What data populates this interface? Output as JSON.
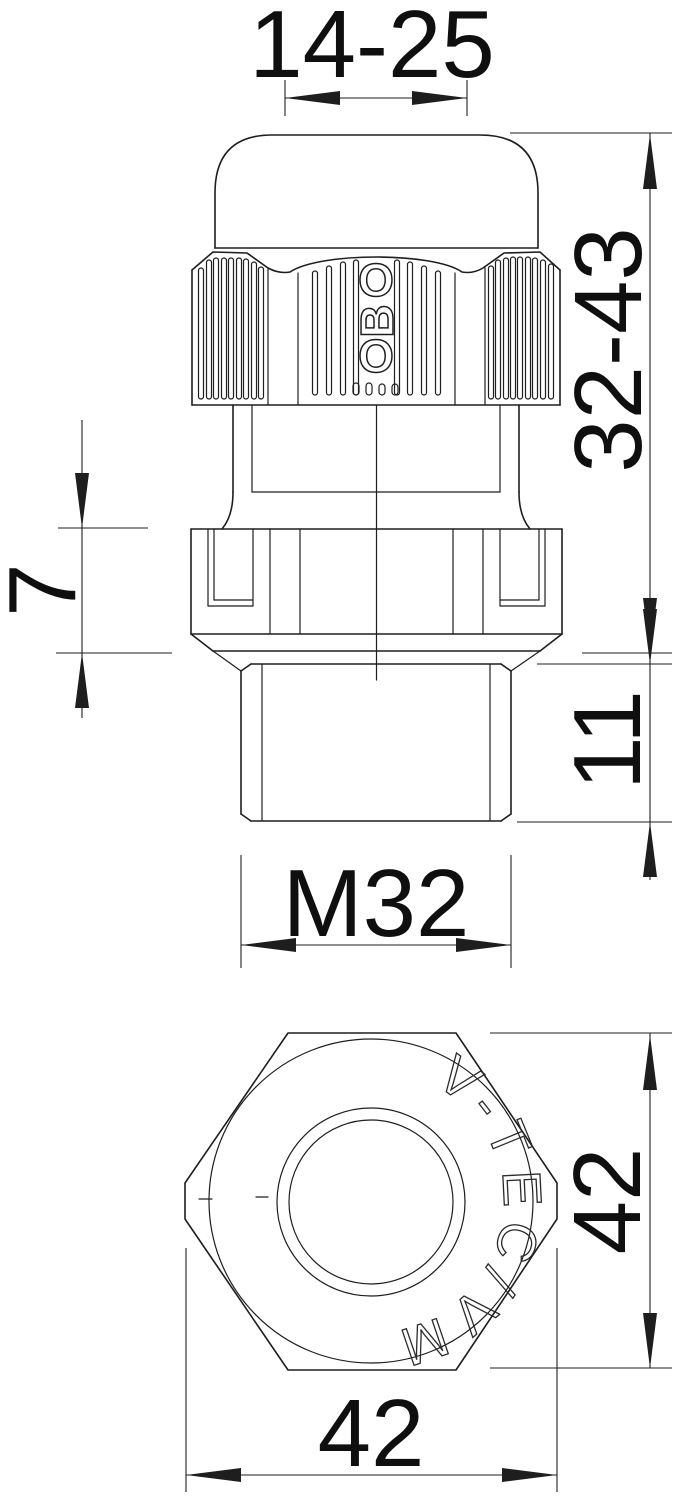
{
  "dimensions": {
    "clamping_range": "14-25",
    "overall_height_range": "32-43",
    "cap_travel": "7",
    "thread_length": "11",
    "thread_size": "M32",
    "wrench_size_side": "42",
    "wrench_size_bottom": "42"
  },
  "branding": {
    "logo_letters": [
      "O",
      "B",
      "O"
    ],
    "engraving": "V-TEC/VM"
  },
  "colors": {
    "line": "#1e1e1e",
    "text": "#0f0f0f",
    "background": "#ffffff"
  }
}
